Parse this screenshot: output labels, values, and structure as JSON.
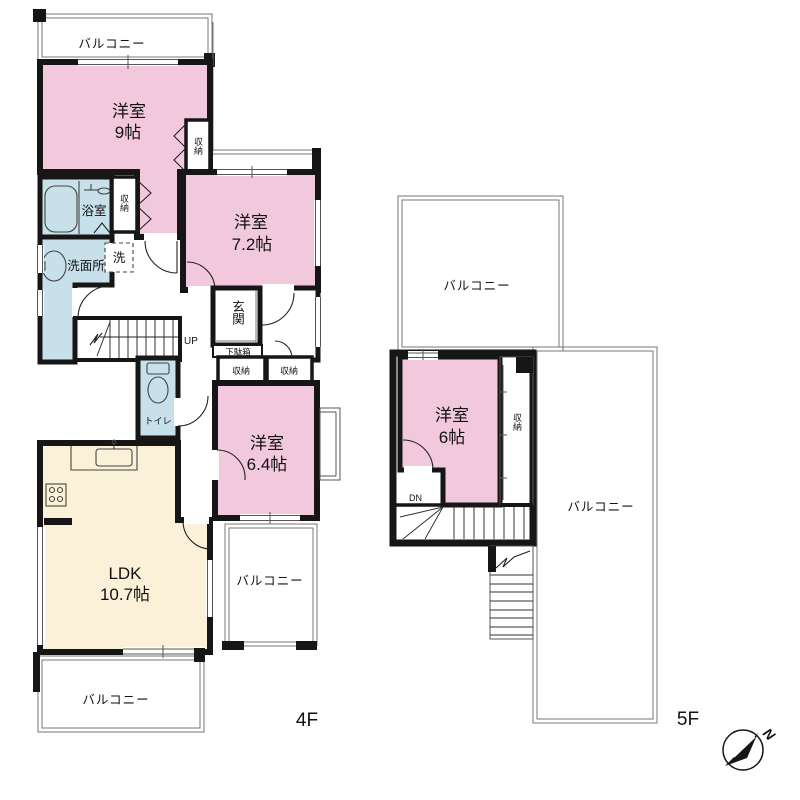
{
  "colors": {
    "room_pink": "#F2C9DC",
    "wet_blue": "#C7E0E9",
    "ldk_cream": "#FAF1D8",
    "wall": "#161616"
  },
  "shared": {
    "balcony": "バルコニー",
    "closet": "収納",
    "western_room": "洋室"
  },
  "floor4": {
    "label": "4F",
    "room9_size": "9帖",
    "room72_size": "7.2帖",
    "room64_size": "6.4帖",
    "ldk_label": "LDK",
    "ldk_size": "10.7帖",
    "bath": "浴室",
    "washroom": "洗面所",
    "washer": "洗",
    "toilet": "トイレ",
    "entrance": "玄関",
    "shoe_cabinet": "下駄箱",
    "stairs_up": "UP"
  },
  "floor5": {
    "label": "5F",
    "room6_size": "6帖",
    "stairs_down": "DN"
  },
  "compass": {
    "north": "N"
  }
}
